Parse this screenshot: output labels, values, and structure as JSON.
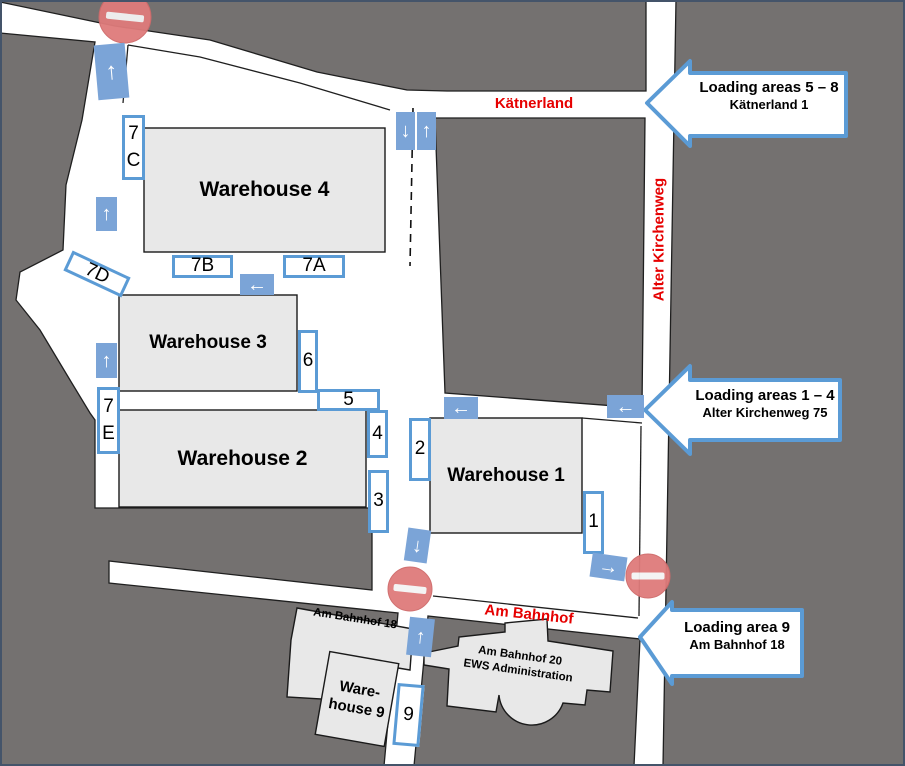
{
  "colors": {
    "background_gray": "#747170",
    "building_fill": "#e8e8e8",
    "accent_blue": "#5b9bd5",
    "arrow_fill": "#7ba4d7",
    "street_red": "#e60000",
    "no_entry_red": "#df7b7b",
    "frame": "#44546a",
    "outline": "#1f1f1f"
  },
  "streets": {
    "kaetnerland": "Kätnerland",
    "alter_kirchenweg": "Alter Kirchenweg",
    "am_bahnhof": "Am Bahnhof"
  },
  "buildings": {
    "warehouse4": "Warehouse 4",
    "warehouse3": "Warehouse 3",
    "warehouse2": "Warehouse 2",
    "warehouse1": "Warehouse 1",
    "warehouse9_lines": [
      "Ware-",
      "house 9"
    ],
    "am_bahnhof_18": "Am Bahnhof 18",
    "administration_lines": [
      "Am Bahnhof 20",
      "EWS Administration"
    ]
  },
  "loading_points": {
    "p7c": "7C",
    "p7b": "7B",
    "p7a": "7A",
    "p7d": "7D",
    "p7e": "7E",
    "p6": "6",
    "p5": "5",
    "p4": "4",
    "p3": "3",
    "p2": "2",
    "p1": "1",
    "p9": "9"
  },
  "callouts": [
    {
      "line1": "Loading areas 5 – 8",
      "line2": "Kätnerland 1"
    },
    {
      "line1": "Loading areas 1 – 4",
      "line2": "Alter Kirchenweg 75"
    },
    {
      "line1": "Loading area 9",
      "line2": "Am Bahnhof 18"
    }
  ],
  "icons": {
    "arrow_up": "↑",
    "arrow_down": "↓",
    "arrow_left": "←",
    "arrow_right": "→"
  }
}
